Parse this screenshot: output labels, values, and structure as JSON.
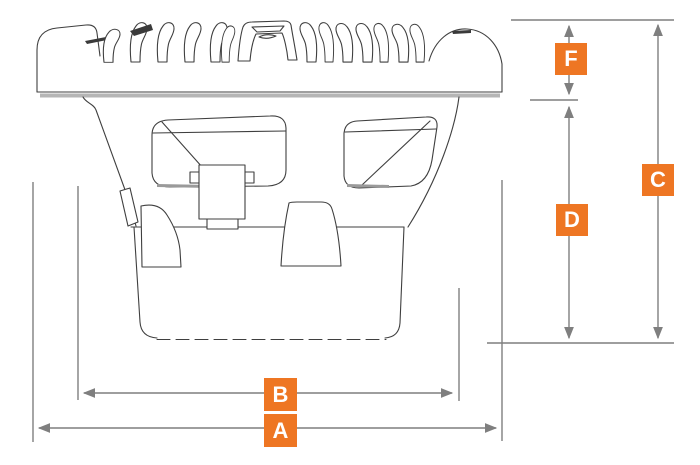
{
  "diagram": {
    "subject": "speaker-side-profile-dimension-drawing",
    "accent_color": "#EE7623",
    "label_text_color": "#FFFFFF",
    "dimension_line_color": "#7F7F7F",
    "artwork_line_color": "#3F3F3F",
    "labels": {
      "a": "A",
      "b": "B",
      "c": "C",
      "d": "D",
      "f": "F"
    }
  }
}
